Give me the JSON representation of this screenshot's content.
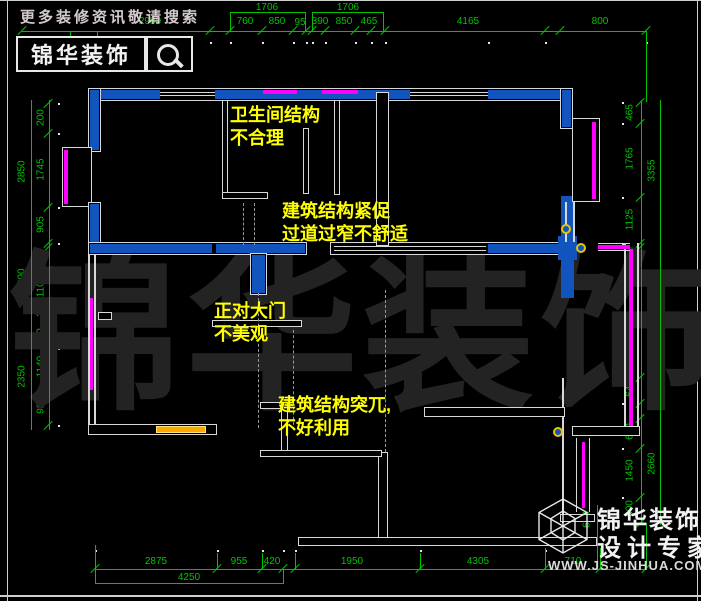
{
  "header": {
    "promo": "更多装修资讯敬请搜索",
    "brand": "锦华装饰"
  },
  "watermark": [
    "锦",
    "华",
    "装",
    "饰"
  ],
  "notes": {
    "bathroom": [
      "卫生间结构",
      "不合理"
    ],
    "corridor": [
      "建筑结构紧促",
      "过道过窄不舒适"
    ],
    "entry": [
      "正对大门",
      "不美观"
    ],
    "structure": [
      "建筑结构突兀,",
      "不好利用"
    ]
  },
  "dims": {
    "top_upper": [
      "1706",
      "1706"
    ],
    "top_lower": [
      "2980",
      "760",
      "850",
      "95",
      "390",
      "850",
      "465",
      "4165",
      "800"
    ],
    "left_inner": [
      "200",
      "1745",
      "905",
      "260",
      "1100",
      "330",
      "290",
      "1140",
      "920"
    ],
    "left_outer": [
      "2850",
      "1690",
      "2350"
    ],
    "right_inner": [
      "465",
      "1765",
      "1125",
      "640",
      "2300",
      "640",
      "610",
      "1450",
      "600"
    ],
    "right_outer": [
      "3355",
      "3580",
      "2660"
    ],
    "bottom_upper": [
      "2875",
      "955",
      "420",
      "1950",
      "4305",
      "710"
    ],
    "bottom_lower": [
      "4250"
    ],
    "misc": [
      "600"
    ]
  },
  "logo": {
    "brand": "锦华装饰",
    "tagline": "设计专家",
    "website": "WWW.JS-JINHUA.COM"
  },
  "colors": {
    "dim_green": "#00c300",
    "wall_blue": "#1254be",
    "window_magenta": "#ff00ff",
    "note_yellow": "#ffff00",
    "furniture_orange": "#ffa800"
  }
}
